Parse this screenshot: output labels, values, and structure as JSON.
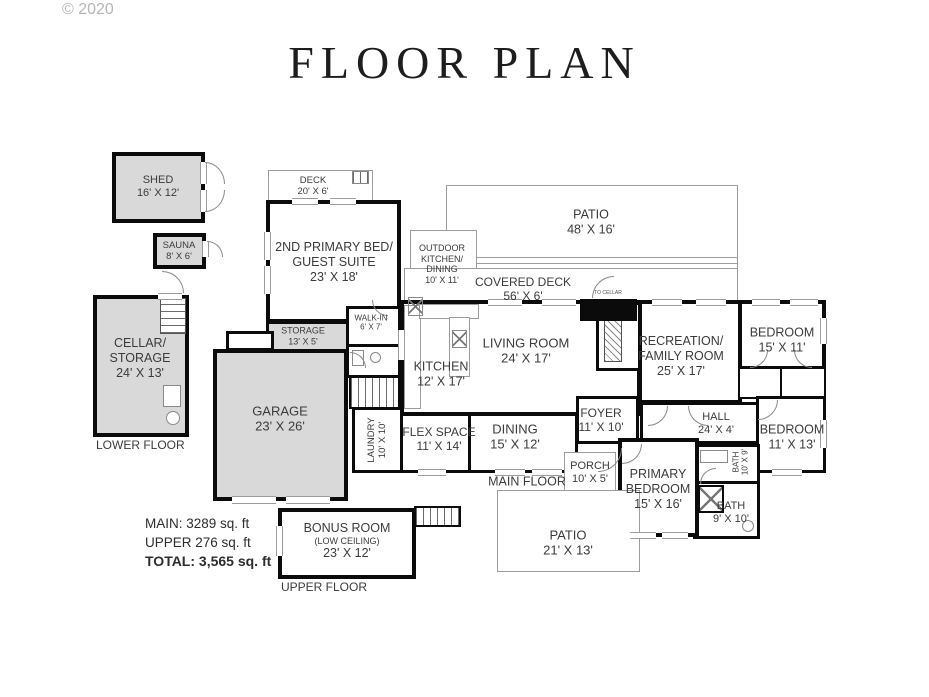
{
  "watermark": "© 2020",
  "title": "FLOOR PLAN",
  "summary": {
    "main": "MAIN: 3289 sq. ft",
    "upper": "UPPER 276 sq. ft",
    "total": "TOTAL: 3,565 sq. ft"
  },
  "floor_labels": {
    "lower": "LOWER FLOOR",
    "main": "MAIN FLOOR",
    "upper": "UPPER FLOOR"
  },
  "rooms": {
    "shed": {
      "lines": [
        "SHED",
        "16' X 12'"
      ]
    },
    "sauna": {
      "lines": [
        "SAUNA",
        "8' X 6'"
      ]
    },
    "cellar": {
      "lines": [
        "CELLAR/",
        "STORAGE",
        "24' X 13'"
      ]
    },
    "deck": {
      "lines": [
        "DECK",
        "20' X 6'"
      ]
    },
    "suite2": {
      "lines": [
        "2ND PRIMARY BED/",
        "GUEST SUITE",
        "23' X 18'"
      ]
    },
    "walkin": {
      "lines": [
        "WALK-IN",
        "6' X 7'"
      ]
    },
    "storage": {
      "lines": [
        "STORAGE",
        "13' X 5'"
      ]
    },
    "garage": {
      "lines": [
        "GARAGE",
        "23' X 26'"
      ]
    },
    "laundry": {
      "lines": [
        "LAUNDRY",
        "10' X 10'"
      ]
    },
    "patio_top": {
      "lines": [
        "PATIO",
        "48' X 16'"
      ]
    },
    "outdoor_kitchen": {
      "lines": [
        "OUTDOOR",
        "KITCHEN/",
        "DINING",
        "10' X 11'"
      ]
    },
    "covered_deck": {
      "lines": [
        "COVERED DECK",
        "56' X 6'"
      ]
    },
    "to_cellar": {
      "lines": [
        "TO CELLAR"
      ]
    },
    "kitchen": {
      "lines": [
        "KITCHEN",
        "12' X 17'"
      ]
    },
    "living": {
      "lines": [
        "LIVING ROOM",
        "24' X 17'"
      ]
    },
    "recreation": {
      "lines": [
        "RECREATION/",
        "FAMILY ROOM",
        "25' X 17'"
      ]
    },
    "bedroom_top": {
      "lines": [
        "BEDROOM",
        "15' X 11'"
      ]
    },
    "flex": {
      "lines": [
        "FLEX SPACE",
        "11' X 14'"
      ]
    },
    "dining": {
      "lines": [
        "DINING",
        "15' X 12'"
      ]
    },
    "foyer": {
      "lines": [
        "FOYER",
        "11' X 10'"
      ]
    },
    "hall": {
      "lines": [
        "HALL",
        "24' X 4'"
      ]
    },
    "bedroom_right": {
      "lines": [
        "BEDROOM",
        "11' X 13'"
      ]
    },
    "bath_small": {
      "lines": [
        "BATH",
        "10' X 9'"
      ]
    },
    "bath": {
      "lines": [
        "BATH",
        "9' X 10'"
      ]
    },
    "porch": {
      "lines": [
        "PORCH",
        "10' X 5'"
      ]
    },
    "primary": {
      "lines": [
        "PRIMARY",
        "BEDROOM",
        "15' X 16'"
      ]
    },
    "patio_bottom": {
      "lines": [
        "PATIO",
        "21' X 13'"
      ]
    },
    "bonus": {
      "lines": [
        "BONUS ROOM",
        "(LOW CEILING)",
        "23' X 12'"
      ]
    }
  }
}
